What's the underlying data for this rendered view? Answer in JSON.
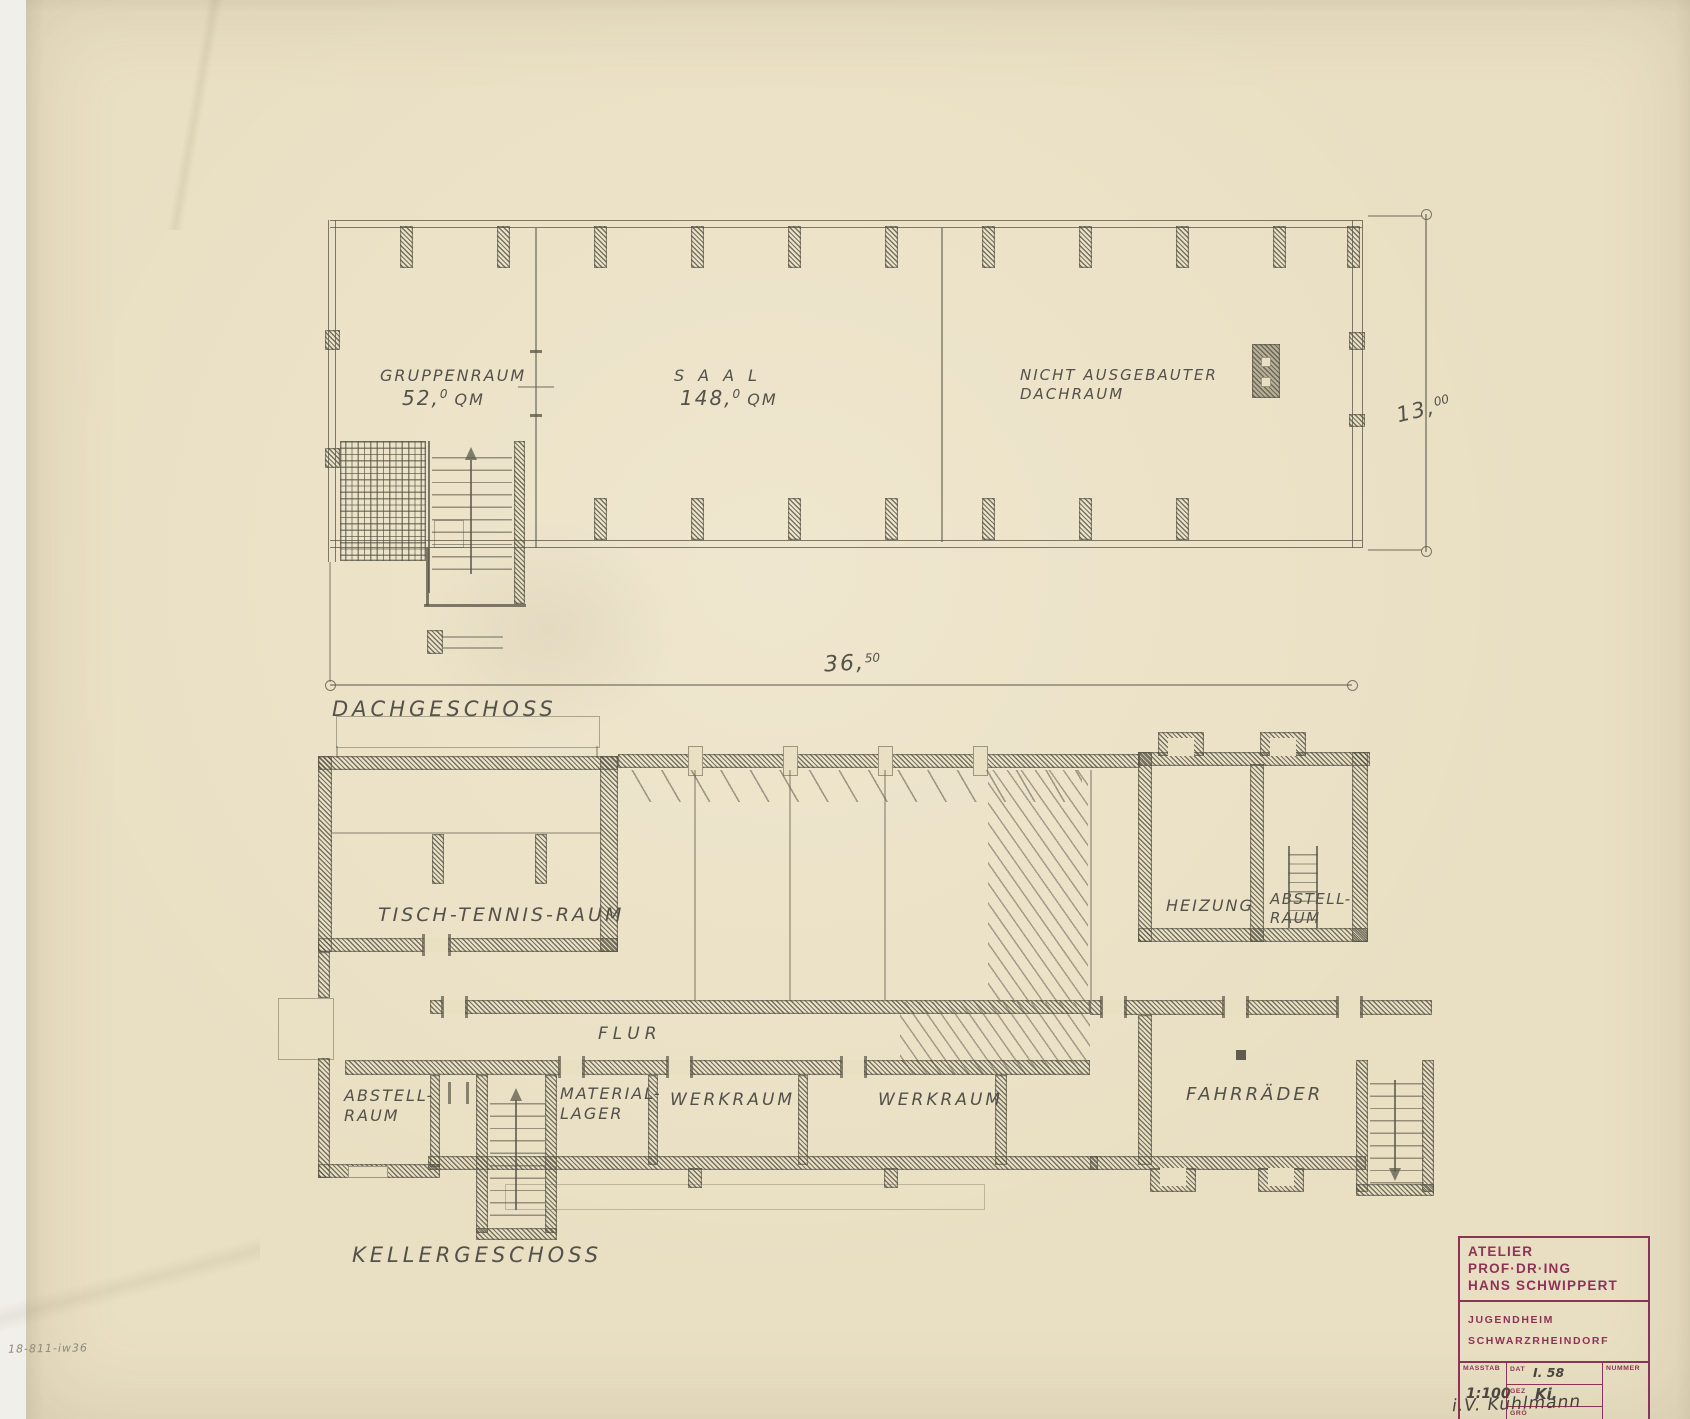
{
  "colors": {
    "paper": "#e9dfc3",
    "pencil": "#5c594a",
    "stamp_purple": "#8e3257"
  },
  "upper_plan": {
    "caption": "DACHGESCHOSS",
    "gruppenraum_name": "GRUPPENRAUM",
    "gruppenraum_area": "52,",
    "gruppenraum_area_sup": "0",
    "gruppenraum_area_unit": " QM",
    "saal_name": "SAAL",
    "saal_area": "148,",
    "saal_area_sup": "0",
    "saal_area_unit": " QM",
    "dachraum_line1": "NICHT AUSGEBAUTER",
    "dachraum_line2": "DACHRAUM",
    "dim_width": "36,",
    "dim_width_sup": "50",
    "dim_height": "13,",
    "dim_height_sup": "00"
  },
  "lower_plan": {
    "caption": "KELLERGESCHOSS",
    "tischtennis": "TISCH-TENNIS-RAUM",
    "heizung": "HEIZUNG",
    "abstell_right_line1": "ABSTELL-",
    "abstell_right_line2": "RAUM",
    "flur": "FLUR",
    "abstell_left_line1": "ABSTELL-",
    "abstell_left_line2": "RAUM",
    "material_line1": "MATERIAL-",
    "material_line2": "LAGER",
    "werkraum_left": "WERKRAUM",
    "werkraum_right": "WERKRAUM",
    "fahrraeder": "FAHRRÄDER"
  },
  "title_block": {
    "studio_line1": "ATELIER PROF·DR·ING",
    "studio_line2": "HANS SCHWIPPERT",
    "project_line1": "JUGENDHEIM",
    "project_line2": "SCHWARZRHEINDORF",
    "masstab_label": "MASSTAB",
    "masstab_value": "1:100",
    "dat_label": "DAT",
    "dat_value": "I. 58",
    "gez_label": "GEZ",
    "gez_value": "Ki.",
    "gro_label": "GRÖ",
    "nummer_label": "NUMMER"
  },
  "annotations": {
    "signature": "i.V. Kühlmann",
    "corner_note": "18-811-iw36"
  }
}
